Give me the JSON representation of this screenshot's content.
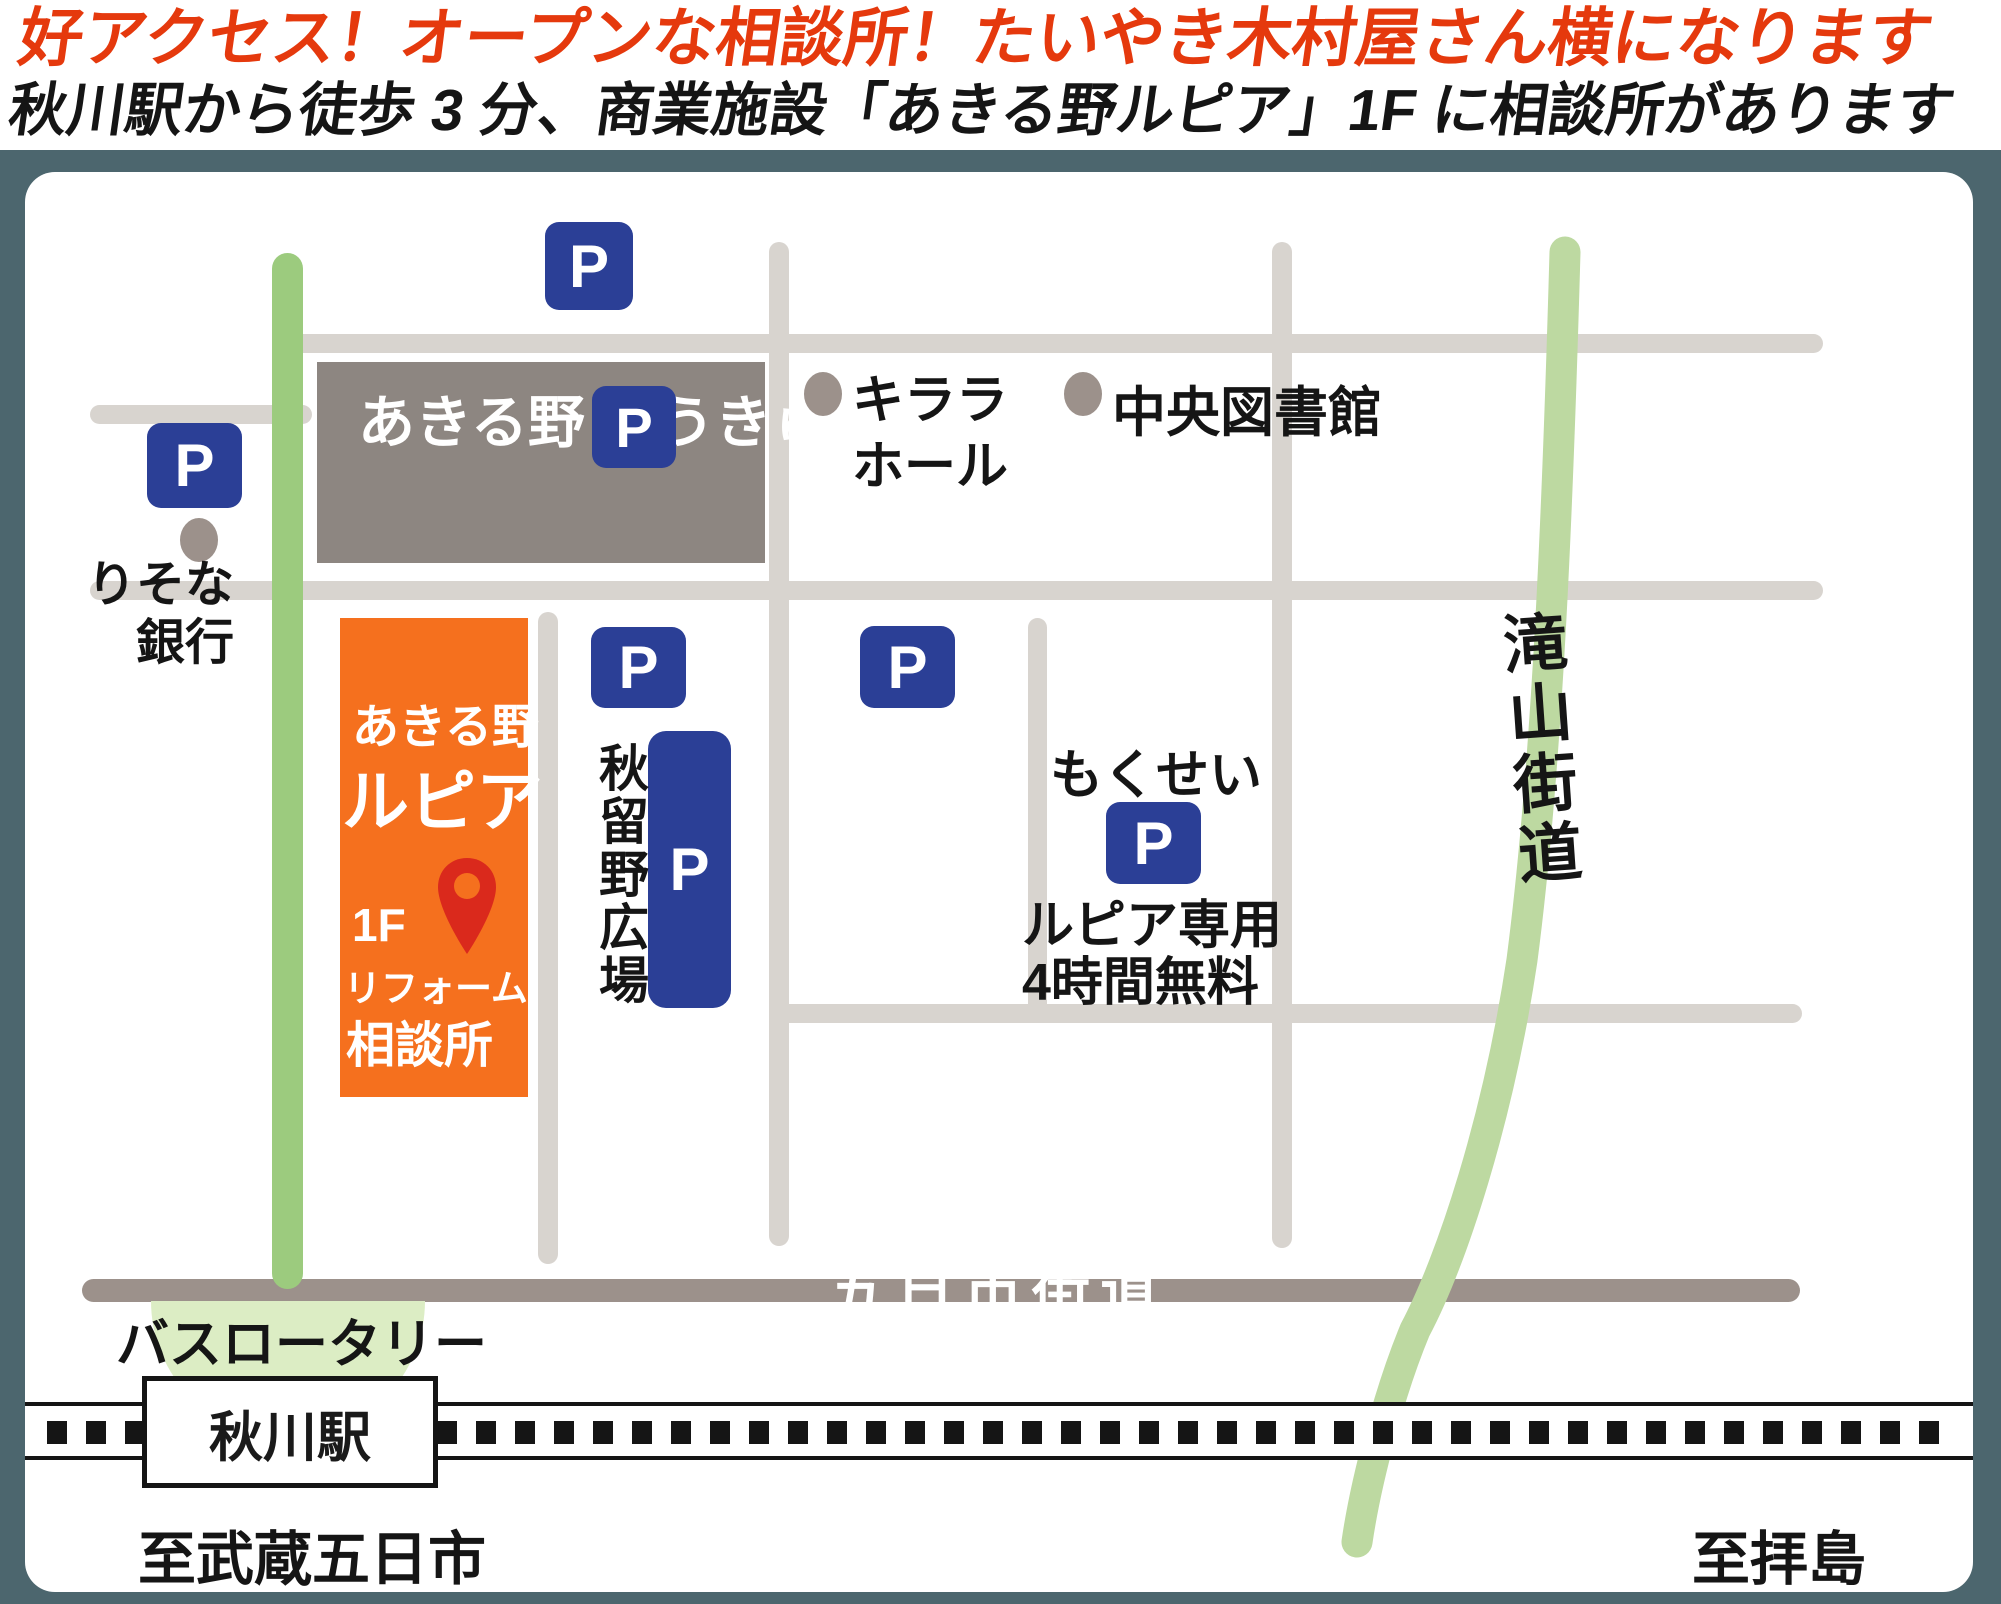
{
  "titles": {
    "line1": "好アクセス！オープンな相談所！たいやき木村屋さん横になります",
    "line2": "秋川駅から徒歩 3 分、商業施設「あきる野ルピア」1F に相談所があります"
  },
  "map": {
    "parking_label": "P",
    "buildings": {
      "tokyu": {
        "line1": "あきる野",
        "line2": "とうきゅう"
      },
      "lupia": {
        "line1": "あきる野",
        "line2": "ルピア",
        "floor": "1F",
        "line3": "リフォーム",
        "line4": "相談所"
      }
    },
    "labels": {
      "risona_line1": "りそな",
      "risona_line2": "銀行",
      "kirara_line1": "キララ",
      "kirara_line2": "ホール",
      "chuo_library": "中央図書館",
      "akiruno_hiroba": "秋留野広場",
      "mokusei": "もくせい",
      "lupia_parking_line1": "ルピア専用",
      "lupia_parking_line2": "4時間無料",
      "takiyama_kaido": "滝山街道",
      "itsukaichi_kaido": "五日市街道",
      "bus_rotary": "バスロータリー",
      "station": "秋川駅",
      "to_left": "至武蔵五日市",
      "to_right": "至拝島"
    },
    "colors": {
      "title_red": "#e5390d",
      "background_slate": "#4c666e",
      "road_gray": "#d8d4cf",
      "road_dark_gray": "#9c918b",
      "building_gray": "#8d8681",
      "building_orange": "#f5701e",
      "parking_blue": "#2b3f96",
      "green_road": "#9ccb7e",
      "green_highway": "#bdd9a1",
      "rotary_green": "#dcedc4",
      "pin_red": "#da291c"
    }
  }
}
